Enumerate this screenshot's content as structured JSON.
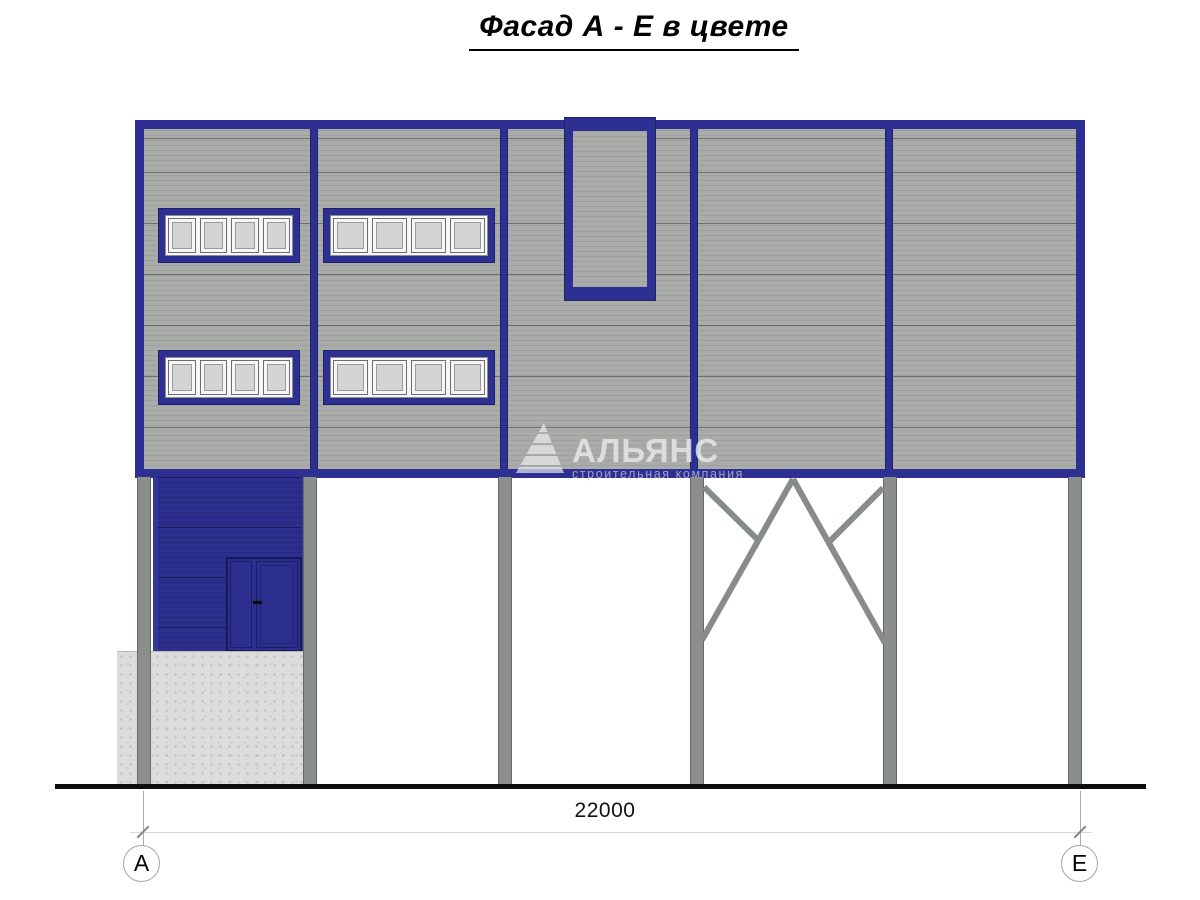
{
  "title": {
    "text": "Фасад А - Е в цвете"
  },
  "watermark": {
    "name": "АЛЬЯНС",
    "tagline": "строительная компания",
    "logo_icon": "sail-triangle-icon"
  },
  "dimension": {
    "total_width_mm": "22000"
  },
  "grid": {
    "left_axis": "А",
    "right_axis": "Е"
  },
  "colors": {
    "frame_blue": "#2d3092",
    "vestibule_blue": "#2c2f8d",
    "panel_gray": "#a9aca9",
    "column_gray": "#8a8f8c",
    "concrete_gray": "#dcdcda",
    "window_glass": "#d3d4d3"
  }
}
